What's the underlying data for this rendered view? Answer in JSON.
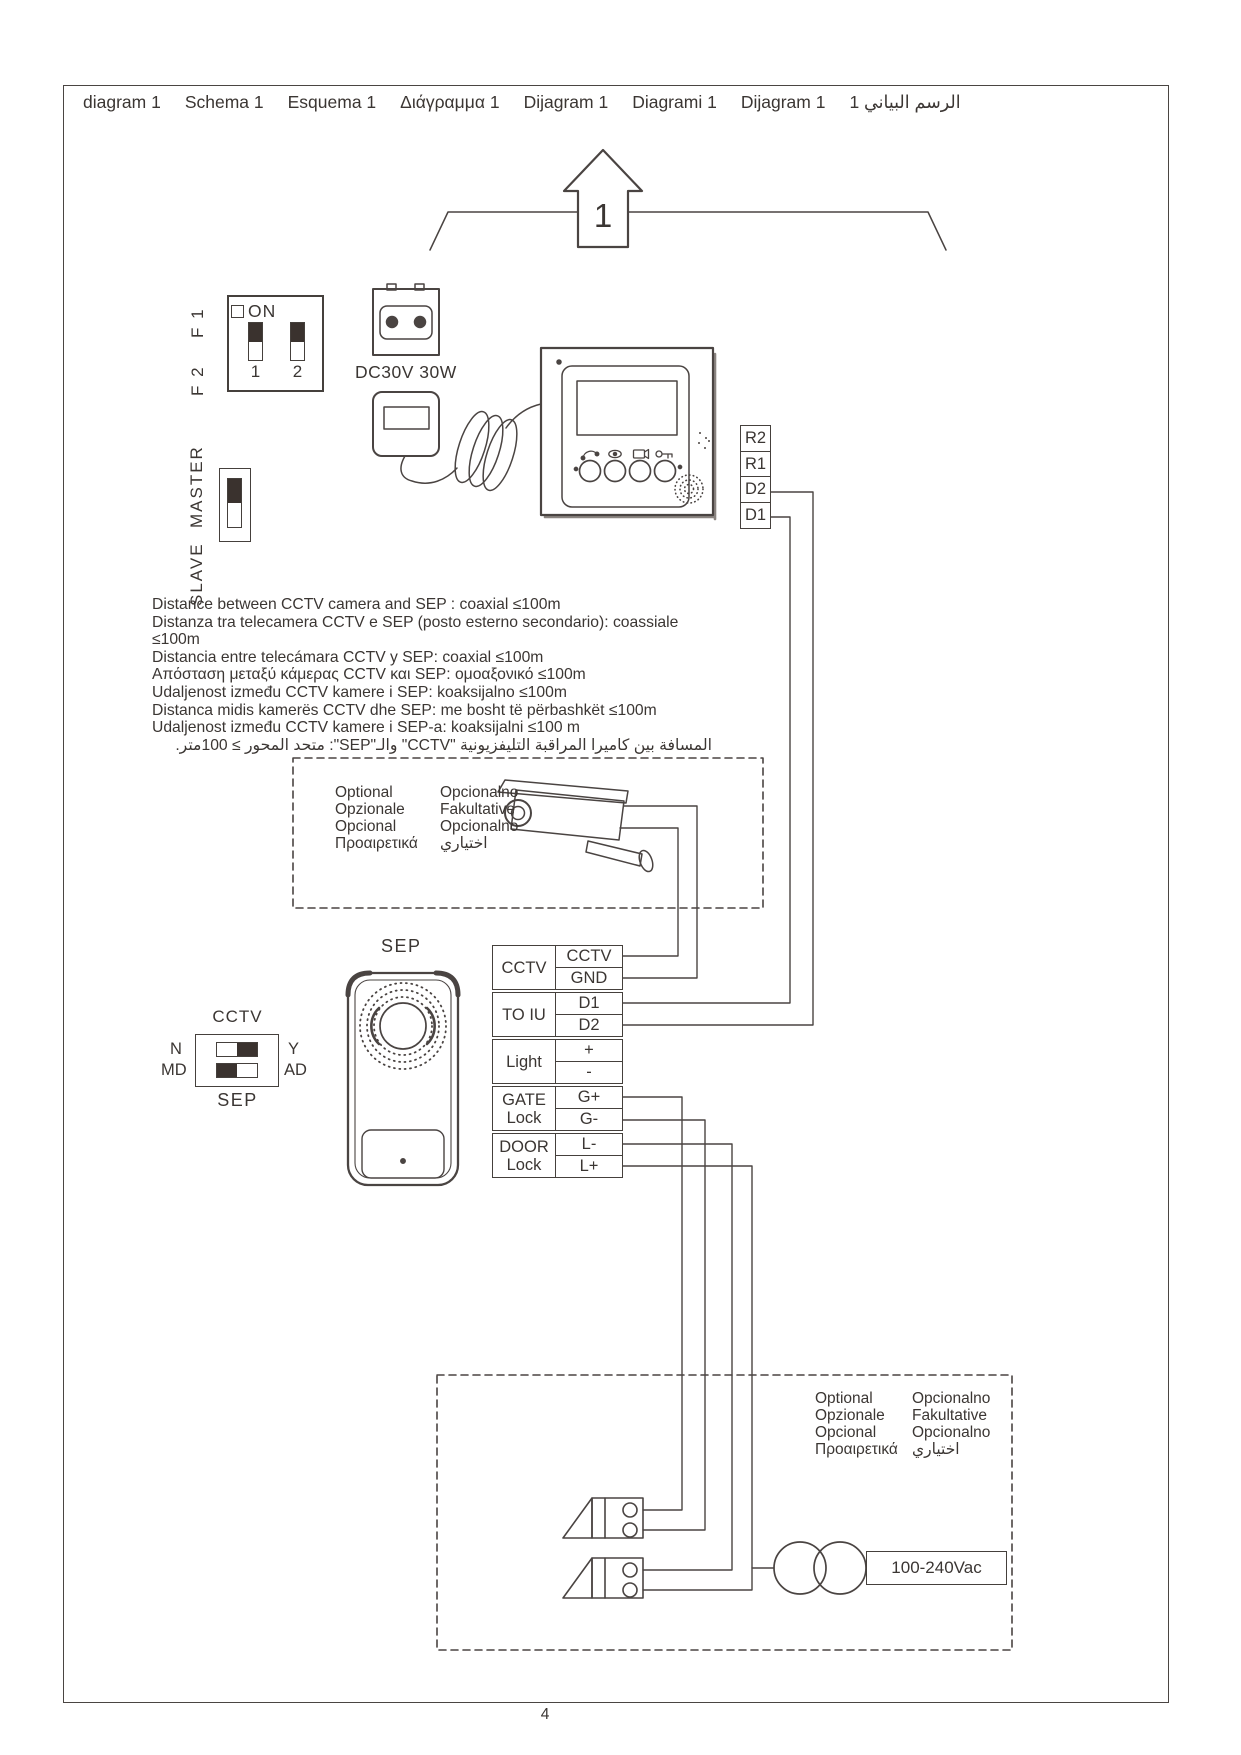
{
  "page": {
    "number": "4"
  },
  "header": {
    "titles": [
      "diagram 1",
      "Schema 1",
      "Esquema 1",
      "Διάγραμμα 1",
      "Dijagram 1",
      "Diagrami 1",
      "Dijagram 1",
      "الرسم البياني 1"
    ]
  },
  "arrow": {
    "label": "1"
  },
  "dip_switch": {
    "on_label": "ON",
    "side_labels": [
      "F 1",
      "F 2"
    ],
    "positions": [
      "1",
      "2"
    ]
  },
  "master_slave": {
    "labels": [
      "MASTER",
      "SLAVE"
    ]
  },
  "power": {
    "adapter_label": "DC30V 30W"
  },
  "monitor_terminals": [
    "R2",
    "R1",
    "D2",
    "D1"
  ],
  "distance_notes": [
    "Distance between CCTV camera and SEP : coaxial ≤100m",
    "Distanza tra telecamera CCTV e SEP (posto esterno secondario): coassiale ≤100m",
    "Distancia entre telecámara CCTV y SEP: coaxial ≤100m",
    "Απόσταση μεταξύ κάμερας CCTV και SEP: ομοαξονικό ≤100m",
    "Udaljenost između CCTV kamere i SEP: koaksijalno ≤100m",
    "Distanca midis kamerës CCTV dhe SEP: me bosht të përbashkët ≤100m",
    "Udaljenost između CCTV kamere i SEP-a: koaksijalni ≤100 m",
    "المسافة بين كاميرا المراقبة التليفزيونية \"CCTV\" والـ\"SEP\": متحد المحور ≥ 100متر."
  ],
  "optional_camera_box": {
    "col1": [
      "Optional",
      "Opzionale",
      "Opcional",
      "Προαιρετικά"
    ],
    "col2": [
      "Opcionalno",
      "Fakultative",
      "Opcionalno",
      "اختياري"
    ]
  },
  "door_station": {
    "label": "SEP"
  },
  "cctv_switch": {
    "top_label": "CCTV",
    "bottom_label": "SEP",
    "left_labels": [
      "N",
      "MD"
    ],
    "right_labels": [
      "Y",
      "AD"
    ]
  },
  "terminal_table": {
    "groups": [
      {
        "label": "CCTV",
        "terminals": [
          "CCTV",
          "GND"
        ]
      },
      {
        "label": "TO IU",
        "terminals": [
          "D1",
          "D2"
        ]
      },
      {
        "label": "Light",
        "terminals": [
          "+",
          "-"
        ]
      },
      {
        "label": "GATE",
        "label2": "Lock",
        "terminals": [
          "G+",
          "G-"
        ]
      },
      {
        "label": "DOOR",
        "label2": "Lock",
        "terminals": [
          "L-",
          "L+"
        ]
      }
    ]
  },
  "optional_power_box": {
    "col1": [
      "Optional",
      "Opzionale",
      "Opcional",
      "Προαιρετικά"
    ],
    "col2": [
      "Opcionalno",
      "Fakultative",
      "Opcionalno",
      "اختياري"
    ],
    "voltage_label": "100-240Vac"
  }
}
